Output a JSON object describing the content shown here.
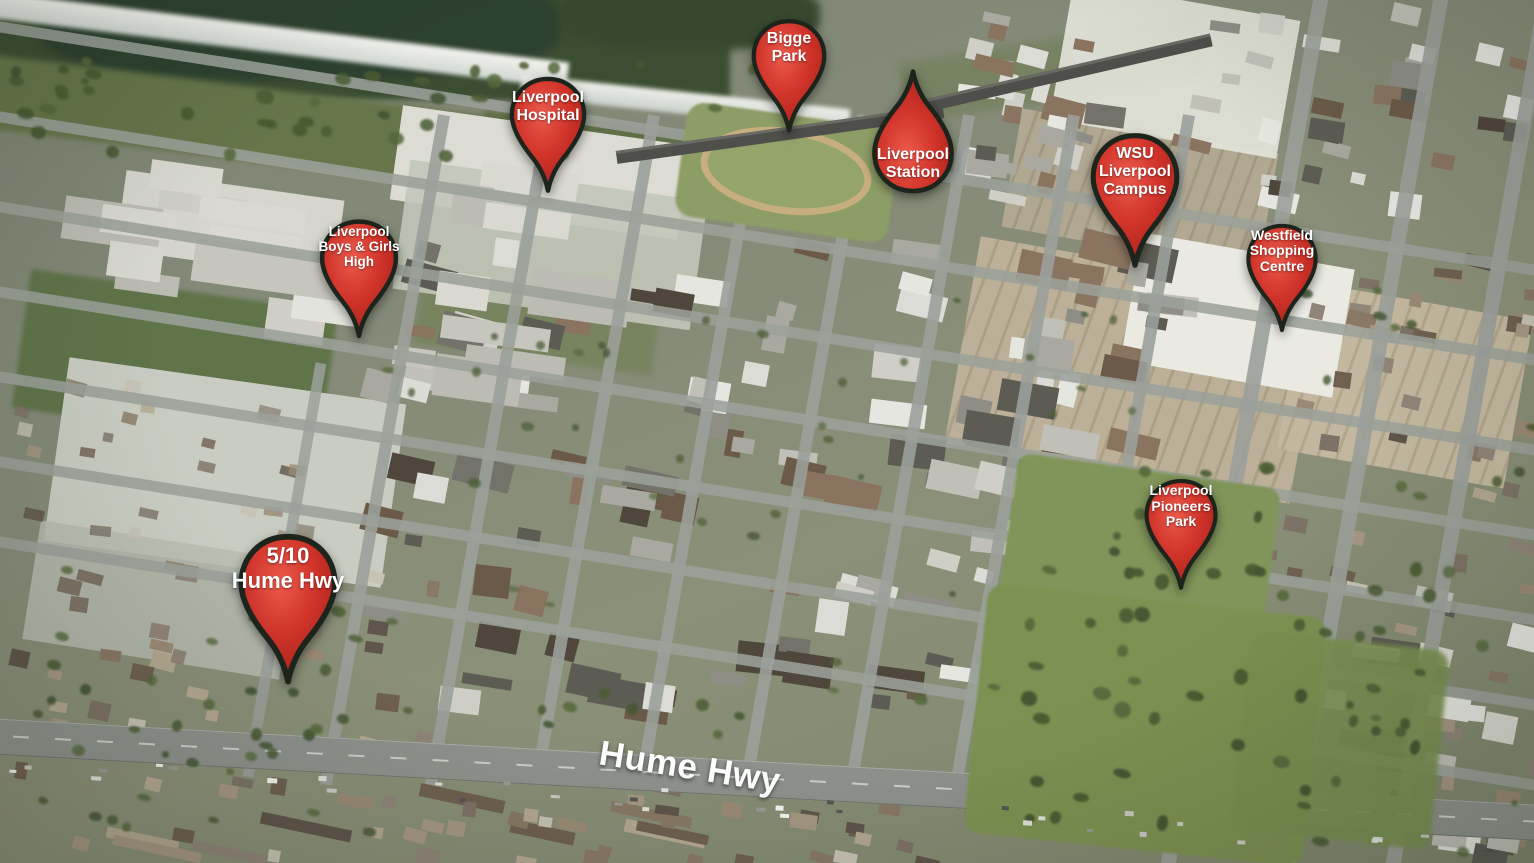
{
  "map": {
    "pins": [
      {
        "id": "bigge-park",
        "label": "Bigge\nPark"
      },
      {
        "id": "liverpool-hospital",
        "label": "Liverpool\nHospital"
      },
      {
        "id": "liverpool-station",
        "label": "Liverpool\nStation",
        "flipped": true
      },
      {
        "id": "liverpool-boys-girls-high",
        "label": "Liverpool\nBoys & Girls\nHigh"
      },
      {
        "id": "wsu-liverpool-campus",
        "label": "WSU\nLiverpool\nCampus"
      },
      {
        "id": "westfield-shopping-centre",
        "label": "Westfield\nShopping\nCentre"
      },
      {
        "id": "liverpool-pioneers-park",
        "label": "Liverpool\nPioneers\nPark"
      },
      {
        "id": "5-10-hume-hwy",
        "label": "5/10\nHume Hwy"
      }
    ],
    "road_labels": [
      "Hume Hwy"
    ],
    "colors": {
      "pin_red": "#cc2d24",
      "pin_outline": "#1c241c",
      "pin_text": "#ffffff",
      "road_label_text": "#ffffff"
    }
  }
}
